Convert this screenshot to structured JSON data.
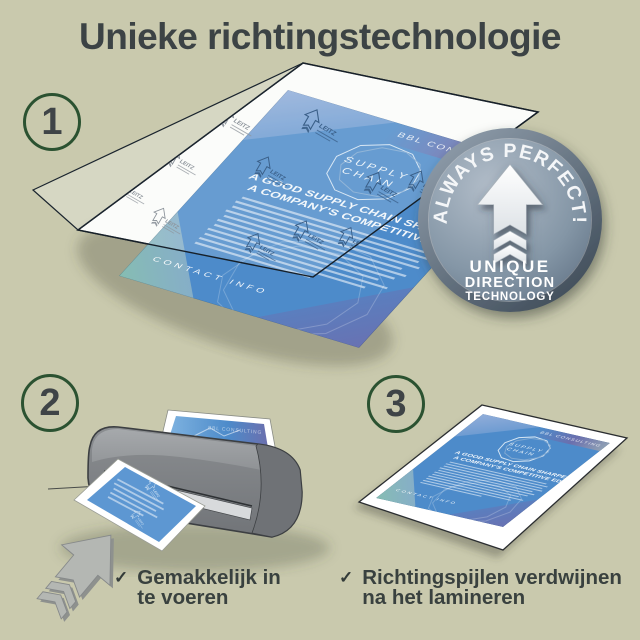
{
  "header": {
    "title": "Unieke richtingstechnologie"
  },
  "steps": [
    {
      "number": "1"
    },
    {
      "number": "2"
    },
    {
      "number": "3"
    }
  ],
  "badge": {
    "curved_text": "ALWAYS PERFECT!",
    "label_line1": "UNIQUE",
    "label_line2": "DIRECTION",
    "label_line3": "TECHNOLOGY",
    "icon": "direction-arrow"
  },
  "document": {
    "brand": "BBL CONSULTING",
    "logo_line1": "SUPPLY",
    "logo_line2": "CHAIN",
    "heading_line1": "A GOOD SUPPLY CHAIN SHARPENS",
    "heading_line2": "A COMPANY'S COMPETITIVE EDGE.",
    "footer": "CONTACT INFO"
  },
  "pouch": {
    "watermark": "LEITZ"
  },
  "captions": [
    {
      "check": "✓",
      "line1": "Gemakkelijk in",
      "line2": "te voeren"
    },
    {
      "check": "✓",
      "line1": "Richtingspijlen verdwijnen",
      "line2": "na het lamineren"
    }
  ],
  "colors": {
    "background": "#c9c9ad",
    "title_text": "#3c4345",
    "step_circle_border": "#2b5231",
    "step_number": "#3f4447",
    "caption_text": "#39413f",
    "flyer_blue": "#4d8bca",
    "badge_steel_light": "#aeb9c7",
    "badge_steel_dark": "#55667a",
    "laminator_gray": "#8b8e91"
  }
}
